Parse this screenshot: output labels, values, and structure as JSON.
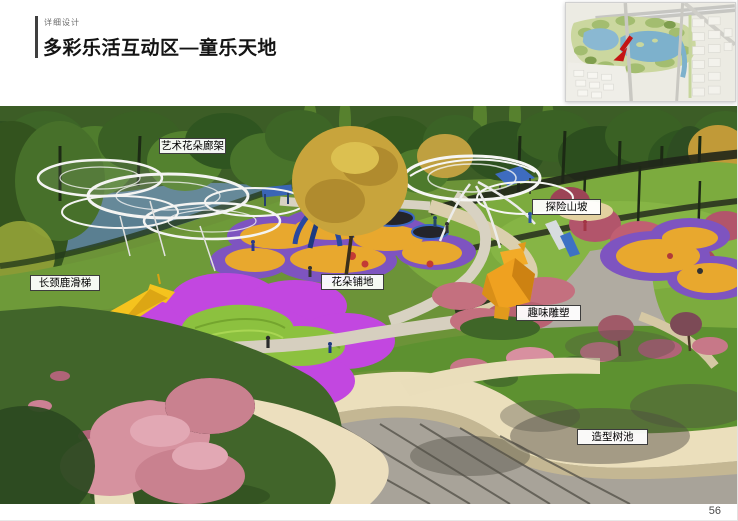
{
  "page": {
    "eyebrow": "详细设计",
    "title": "多彩乐活互动区—童乐天地",
    "page_number": "56",
    "accent_bar_color": "#3f3f3f"
  },
  "locator_map": {
    "marker": "red-arrow",
    "marker_color": "#c41414",
    "water_color": "#7db1cc",
    "park_color": "#cbd79f"
  },
  "render": {
    "callouts": [
      {
        "label": "艺术花朵廊架"
      },
      {
        "label": "探险山坡"
      },
      {
        "label": "长颈鹿滑梯"
      },
      {
        "label": "花朵铺地"
      },
      {
        "label": "趣味雕塑"
      },
      {
        "label": "造型树池"
      }
    ],
    "features": [
      {
        "name": "art-flower-pergola",
        "color": "#f4f4f2"
      },
      {
        "name": "adventure-hill-lawn",
        "color": "#7cab3e"
      },
      {
        "name": "giraffe-slide",
        "color": "#f5c31e"
      },
      {
        "name": "flower-paving",
        "color": "#c247e0"
      },
      {
        "name": "sand-play-area",
        "color": "#e8a82e"
      },
      {
        "name": "bear-sculpture",
        "color": "#efa120"
      },
      {
        "name": "shaped-planter-wall",
        "color": "#ebdfbc"
      },
      {
        "name": "lake-water",
        "color": "#5a7f91"
      },
      {
        "name": "concrete-plaza",
        "color": "#aca79d"
      }
    ]
  }
}
